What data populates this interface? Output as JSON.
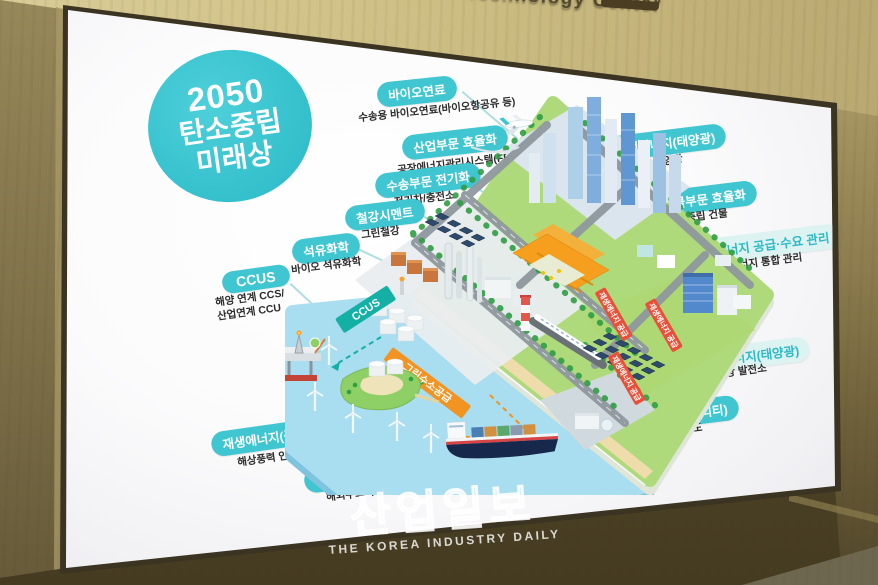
{
  "signage": {
    "building_sign": "Climate Technology Center"
  },
  "watermark": {
    "logo": "산업일보",
    "tagline": "THE KOREA INDUSTRY DAILY"
  },
  "poster": {
    "title": {
      "line1": "2050",
      "line2": "탄소중립",
      "line3": "미래상"
    },
    "labels": [
      {
        "id": "bio-fuel",
        "label": "바이오연료",
        "caption": "수송용 바이오연료(바이오항공유 등)"
      },
      {
        "id": "industry-efficiency",
        "label": "산업부문 효율화",
        "caption": "공장에너지관리시스템(FEMS)"
      },
      {
        "id": "transport-electrify",
        "label": "수송부문 전기화",
        "caption": "전기차/충전소"
      },
      {
        "id": "steel-cement",
        "label": "철강시멘트",
        "caption": "그린철강"
      },
      {
        "id": "petrochemical",
        "label": "석유화학",
        "caption": "바이오 석유화학"
      },
      {
        "id": "ccus",
        "label": "CCUS",
        "caption": "해양 연계 CCS/\n산업연계 CCU"
      },
      {
        "id": "renewable-solar-city",
        "label": "재생에너지(태양광)",
        "caption": "도시형 태양광"
      },
      {
        "id": "building-efficiency",
        "label": "건물부문 효율화",
        "caption": "탄소중립 건물"
      },
      {
        "id": "energy-supply-demand",
        "label": "에너지 공급·수요 관리",
        "caption": "에너지 통합 관리"
      },
      {
        "id": "renewable-solar-plant",
        "label": "재생에너지(태양광)",
        "caption": "태양광 발전소"
      },
      {
        "id": "hydrogen-mobility",
        "label": "수소 활용(모빌리티)",
        "caption": "수소차/수소철도"
      },
      {
        "id": "hydrogen-production",
        "label": "수소생산",
        "caption": "그린수소 생산"
      },
      {
        "id": "renewable-wind",
        "label": "재생에너지(풍력)",
        "caption": "해상풍력 인공섬"
      },
      {
        "id": "hydrogen-storage",
        "label": "수소 저장·운송",
        "caption": "해외수소 수입"
      }
    ],
    "ribbons": {
      "ccus": "CCUS",
      "green_hydrogen_supply": "그린수소공급",
      "renewable_energy_supply": "재생에너지 공급"
    },
    "illustration_elements": [
      "airplane",
      "skyscrapers",
      "green-steel-factory",
      "petrochemical-plant",
      "storage-tanks",
      "striped-chimney",
      "high-speed-train",
      "solar-panel-farm",
      "office-buildings",
      "cargo-ship",
      "artificial-island",
      "offshore-wind-turbines",
      "offshore-platform",
      "sea",
      "roads",
      "trees"
    ],
    "colors": {
      "accent_teal": "#3fc6d0",
      "ribbon_teal": "#14b0a6",
      "ribbon_orange": "#f29422",
      "ribbon_red": "#e8503a",
      "sea_blue": "#a9ddf0",
      "land_green": "#aeda7c"
    }
  }
}
